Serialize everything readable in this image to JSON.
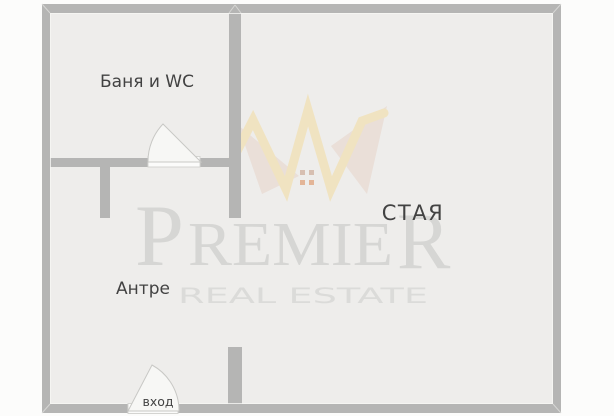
{
  "floorplan": {
    "rooms": [
      {
        "name": "bathroom",
        "label": "Баня и WC"
      },
      {
        "name": "hallway",
        "label": "Антре"
      },
      {
        "name": "living-room",
        "label": "СТАЯ"
      }
    ],
    "entrance": {
      "label": "вход"
    }
  },
  "watermark": {
    "brand_part1": "P",
    "brand_part2": "REMIE",
    "brand_part3": "R",
    "tagline": "REAL ESTATE"
  },
  "colors": {
    "page_bg": "#fcfcfb",
    "floor": "#eeedeb",
    "wall": "#b5b5b4",
    "wall_miter": "#d6d6d4",
    "inner_edge": "#f6f6f4",
    "door_fill": "#f7f7f5",
    "door_stroke": "#c8c8c5",
    "sill_fill": "#fbfbfa",
    "sill_stroke": "#d4d4d1",
    "label_text": "#424242",
    "brand_gray": "#d6d6d4",
    "tagline_gray": "#dbdbd9",
    "crown_yellow": "#f1e0b4",
    "crown_shadow": "#e6d3c8",
    "window_top": "#c9a18b",
    "window_bottom": "#dd9060"
  }
}
